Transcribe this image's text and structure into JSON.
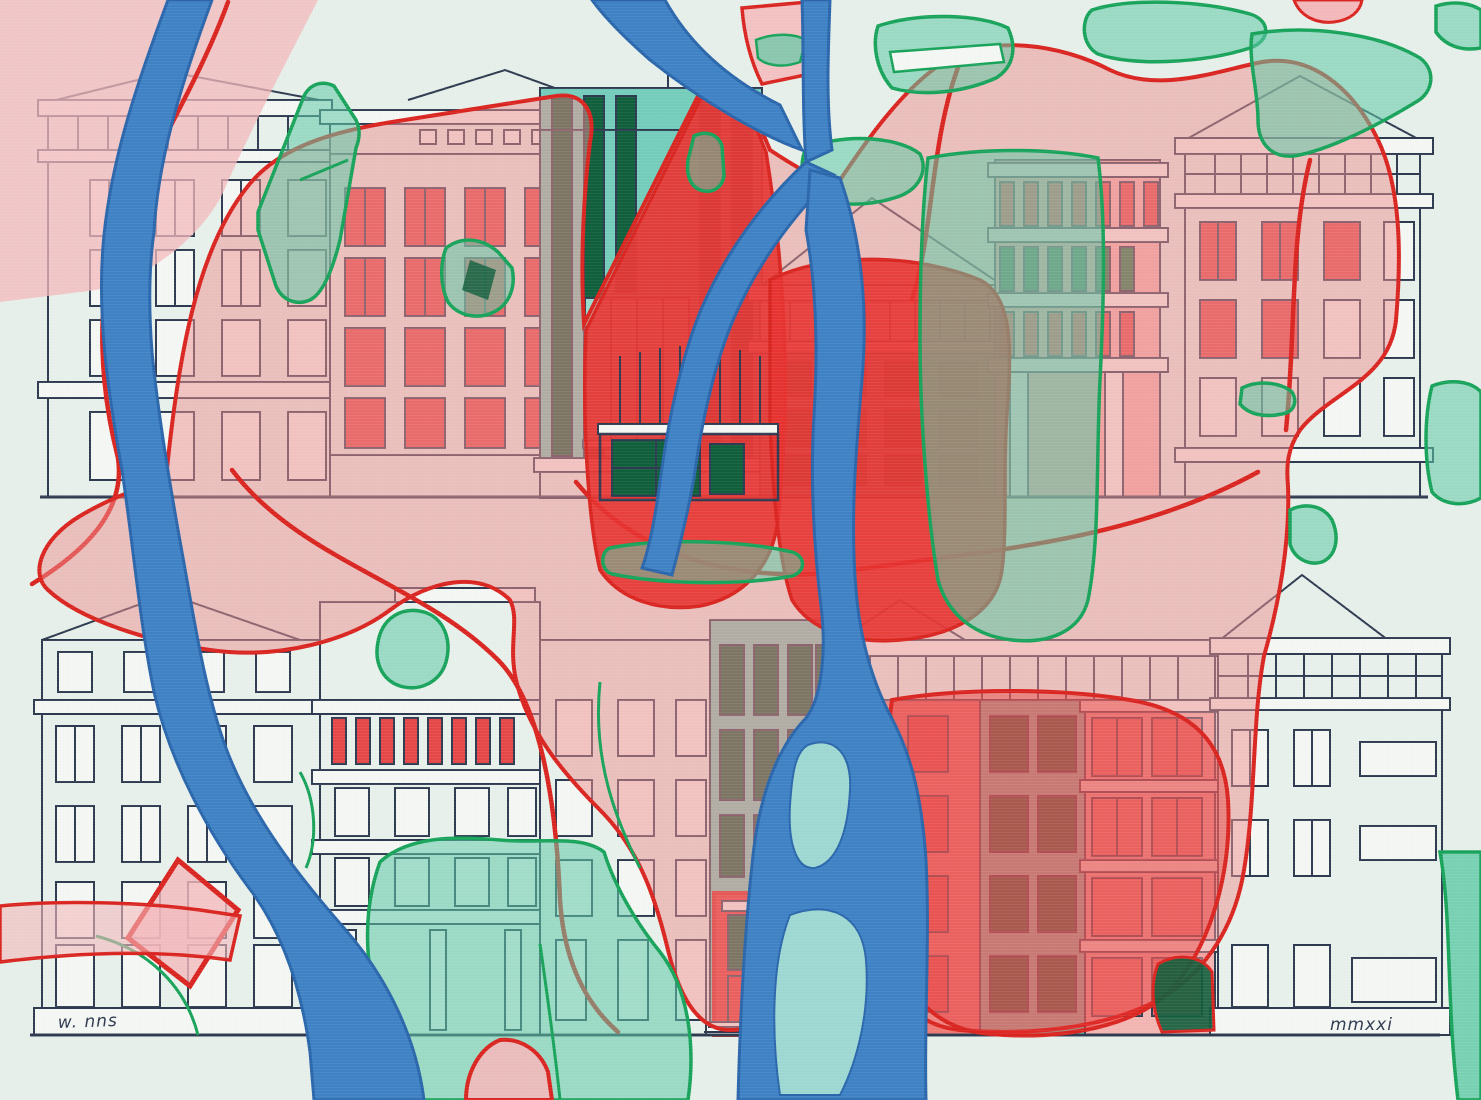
{
  "artwork": {
    "type": "painting",
    "description": "Abstract city-map overlay painted across rows of building facades: blue rivers, red and pink districts with red road outlines, and green park parcels over ink-drawn apartment blocks.",
    "signature": "w. nns",
    "date_inscription": "mmxxi",
    "palette": {
      "bg": "#e6efe9",
      "ink": "#2e3a50",
      "bLight": "#e7f0ea",
      "slab": "#f4f7f3",
      "tealB": "#74cdbb",
      "tLight": "#9adccb",
      "winGreen": "#1c7a4b",
      "winGreenDark": "#0f5e3c",
      "winRed": "#e64848",
      "fSalmon": "#ef7b74",
      "fPinkish": "#f2b5b2",
      "pinkZone": "#ee8e8d",
      "pinkParcel": "#f4b8bb",
      "redSolid": "#e73230",
      "redLine": "#da2420",
      "greenZone": "#5cc9a5",
      "greenLine": "#18a35b",
      "river": "#3e81c4",
      "riverEdge": "#2a66ab",
      "island": "#9ed8d2"
    }
  }
}
